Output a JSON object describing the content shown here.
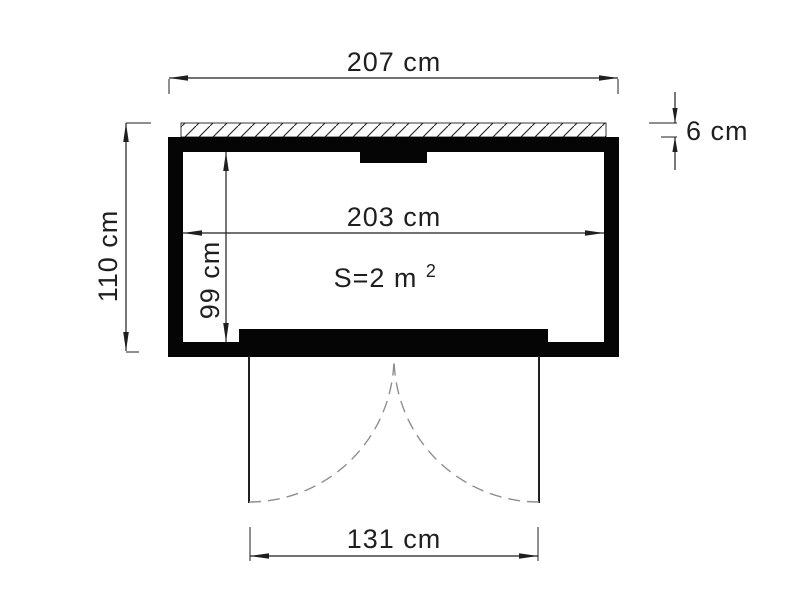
{
  "figure": {
    "kind": "shed-floor-plan-technical-drawing",
    "dimensions": {
      "overall_width": "207 cm",
      "overall_height": "110 cm",
      "roof_thickness": "6 cm",
      "inner_width": "203 cm",
      "inner_depth": "99 cm",
      "door_opening_width": "131 cm"
    },
    "area_label": {
      "base": "S=2 m",
      "superscript": "2"
    },
    "colors": {
      "wall": "#050505",
      "dimension_line": "#1f1f1f",
      "door_swing_arc": "#8f8f8f",
      "background": "#ffffff"
    }
  }
}
